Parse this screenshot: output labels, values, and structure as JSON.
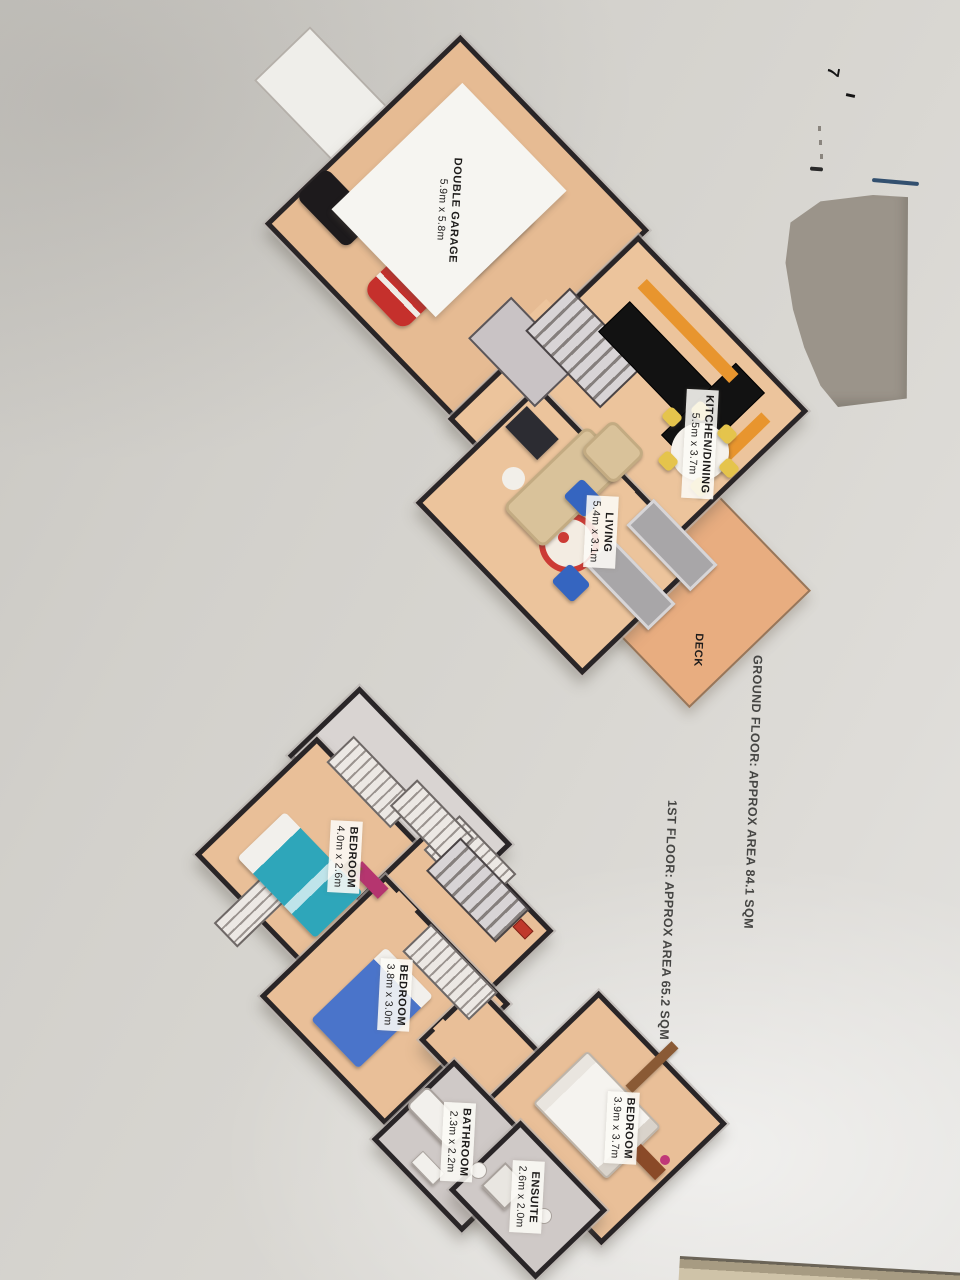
{
  "document": {
    "kind": "3d-floor-plan-photo",
    "watermark_partial": "hoto Plan.",
    "handwritten_mark": "7"
  },
  "ground_floor": {
    "caption": "GROUND FLOOR: APPROX AREA 84.1 SQM",
    "rooms": {
      "garage": {
        "name": "DOUBLE GARAGE",
        "dims": "5.9m x 5.8m"
      },
      "kitchen": {
        "name": "KITCHEN/DINING",
        "dims": "5.5m x 3.7m"
      },
      "living": {
        "name": "LIVING",
        "dims": "5.4m x 3.1m"
      },
      "deck": {
        "name": "DECK"
      }
    }
  },
  "first_floor": {
    "caption": "1ST FLOOR: APPROX AREA 65.2 SQM",
    "rooms": {
      "bedroom1": {
        "name": "BEDROOM",
        "dims": "4.0m x 2.6m"
      },
      "bedroom2": {
        "name": "BEDROOM",
        "dims": "3.8m x 3.0m"
      },
      "bedroom3": {
        "name": "BEDROOM",
        "dims": "3.9m x 3.7m"
      },
      "bathroom": {
        "name": "BATHROOM",
        "dims": "2.3m x 2.2m"
      },
      "ensuite": {
        "name": "ENSUITE",
        "dims": "2.6m x 2.0m"
      }
    }
  },
  "colors": {
    "paper": "#d4d2cd",
    "wall": "#292527",
    "floor": "#e9bf98",
    "deck": "#e8ad80",
    "red_car": "#c5302c",
    "teal_bed": "#2ea6ba",
    "blue_bed": "#4a74ca",
    "yellow_chair": "#e5c44c",
    "magenta_accent": "#b5356f",
    "redaction_gray": "#9b948a",
    "pen_line_blue": "#33506f"
  }
}
